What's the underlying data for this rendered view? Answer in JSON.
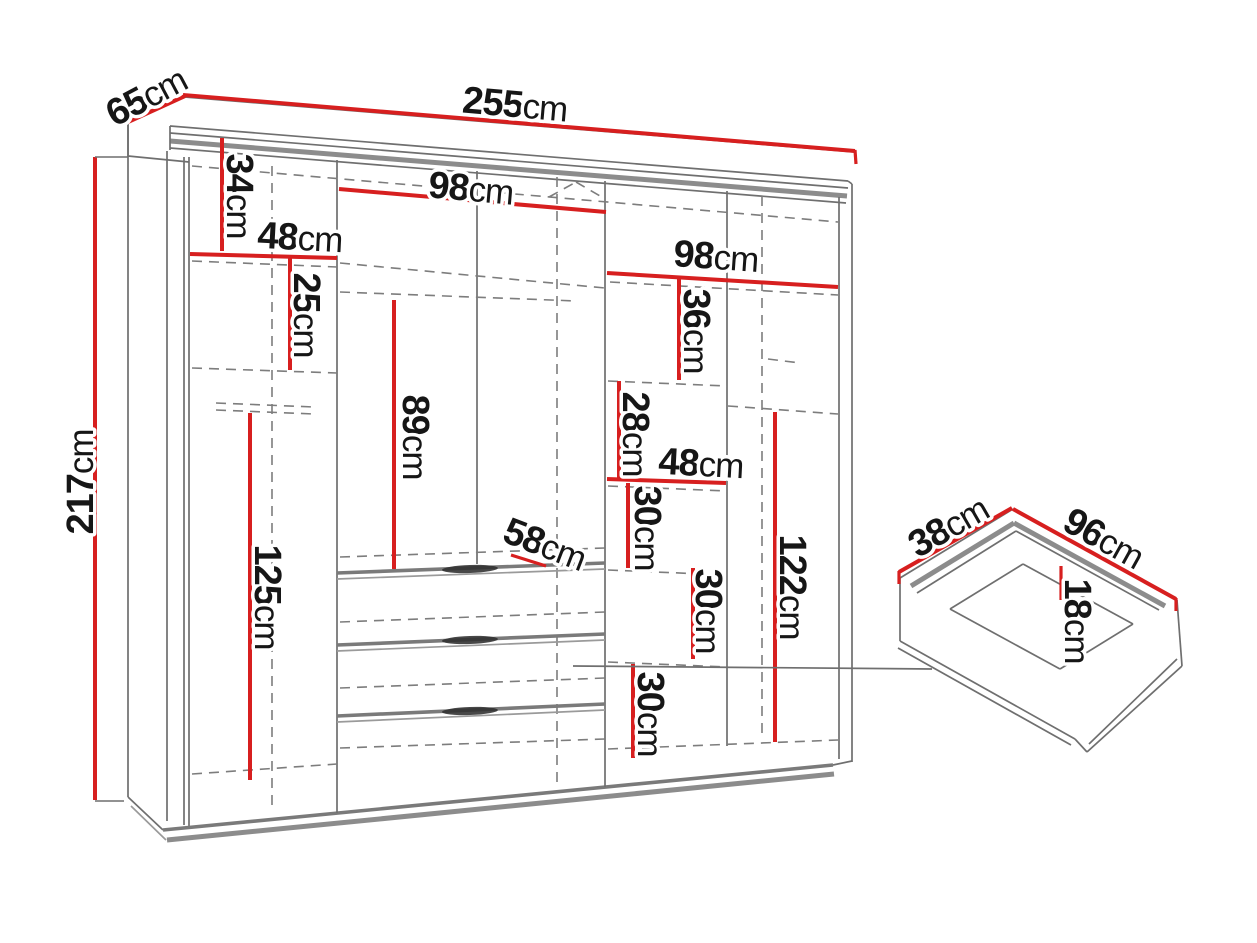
{
  "diagram": {
    "type": "furniture-dimension-diagram",
    "subject": "wardrobe-with-drawer-detail",
    "unit": "cm",
    "colors": {
      "dimension_line": "#d71f1f",
      "structure_line": "#6f6f6f",
      "label_text": "#161616",
      "background": "#ffffff"
    },
    "dims": {
      "depth": {
        "value": "65",
        "unit": "cm"
      },
      "width": {
        "value": "255",
        "unit": "cm"
      },
      "height": {
        "value": "217",
        "unit": "cm"
      },
      "left_top_shelf": {
        "value": "34",
        "unit": "cm"
      },
      "left_width": {
        "value": "48",
        "unit": "cm"
      },
      "left_shelf_space": {
        "value": "25",
        "unit": "cm"
      },
      "left_door_space": {
        "value": "125",
        "unit": "cm"
      },
      "mid_width": {
        "value": "98",
        "unit": "cm"
      },
      "mid_hanging_space": {
        "value": "89",
        "unit": "cm"
      },
      "interior_depth": {
        "value": "58",
        "unit": "cm"
      },
      "right_width": {
        "value": "98",
        "unit": "cm"
      },
      "right_top_shelf": {
        "value": "36",
        "unit": "cm"
      },
      "right_space_28": {
        "value": "28",
        "unit": "cm"
      },
      "right_half_width": {
        "value": "48",
        "unit": "cm"
      },
      "right_space_30a": {
        "value": "30",
        "unit": "cm"
      },
      "right_space_30b": {
        "value": "30",
        "unit": "cm"
      },
      "right_space_30c": {
        "value": "30",
        "unit": "cm"
      },
      "right_hanging_space": {
        "value": "122",
        "unit": "cm"
      },
      "drawer_depth": {
        "value": "38",
        "unit": "cm"
      },
      "drawer_width": {
        "value": "96",
        "unit": "cm"
      },
      "drawer_height": {
        "value": "18",
        "unit": "cm"
      }
    }
  }
}
